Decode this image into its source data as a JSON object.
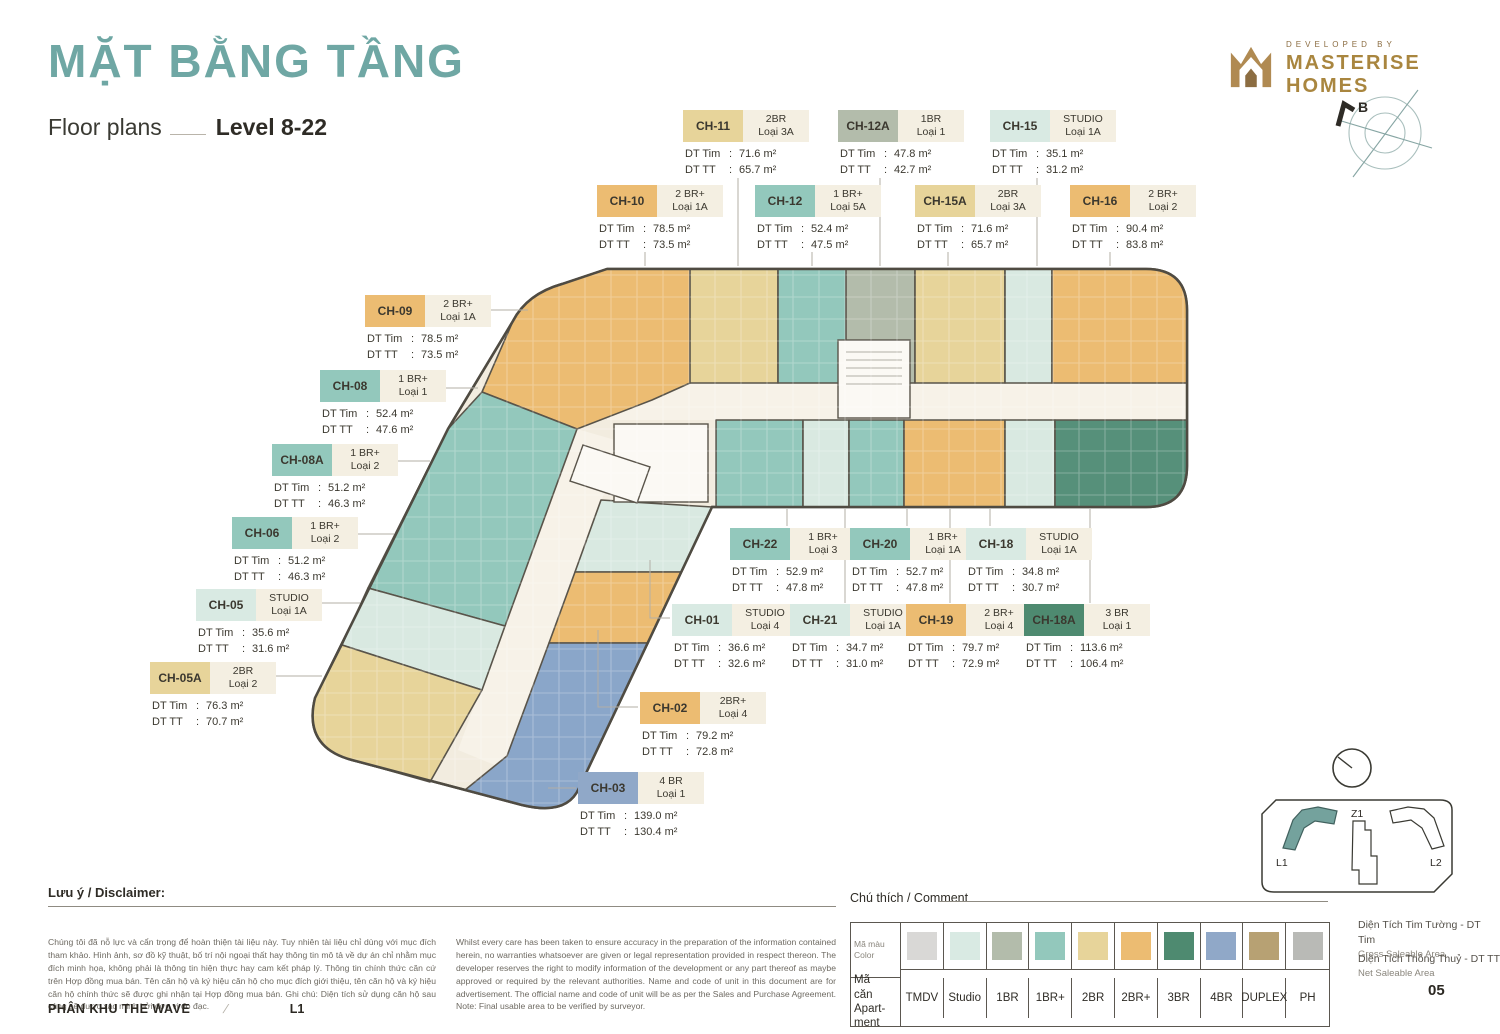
{
  "header": {
    "title": "MẶT BẰNG TẦNG",
    "subtitle_left": "Floor plans",
    "subtitle_right": "Level 8-22",
    "developer_label": "DEVELOPED BY",
    "developer_name": "MASTERISE HOMES",
    "compass_label": "B"
  },
  "colors": {
    "tmdv": "#d9d8d6",
    "studio": "#d9eae3",
    "br1": "#b3bcab",
    "br1p": "#93c8bc",
    "br2": "#e7d49a",
    "br2p": "#ecbc72",
    "br3": "#4e8a70",
    "br4": "#90a8c8",
    "duplex": "#b7a173",
    "ph": "#b9bab6"
  },
  "callout_labels": {
    "dt_tim": "DT Tim",
    "dt_tt": "DT TT"
  },
  "callouts": [
    {
      "code": "CH-11",
      "type": "2BR",
      "loai": "Loại 3A",
      "dt_tim": "71.6 m²",
      "dt_tt": "65.7 m²",
      "key": "br2",
      "x": 683,
      "y": 110
    },
    {
      "code": "CH-12A",
      "type": "1BR",
      "loai": "Loại 1",
      "dt_tim": "47.8 m²",
      "dt_tt": "42.7 m²",
      "key": "br1",
      "x": 838,
      "y": 110
    },
    {
      "code": "CH-15",
      "type": "STUDIO",
      "loai": "Loại 1A",
      "dt_tim": "35.1 m²",
      "dt_tt": "31.2 m²",
      "key": "studio",
      "x": 990,
      "y": 110
    },
    {
      "code": "CH-10",
      "type": "2 BR+",
      "loai": "Loại 1A",
      "dt_tim": "78.5 m²",
      "dt_tt": "73.5 m²",
      "key": "br2p",
      "x": 597,
      "y": 185
    },
    {
      "code": "CH-12",
      "type": "1 BR+",
      "loai": "Loại 5A",
      "dt_tim": "52.4 m²",
      "dt_tt": "47.5 m²",
      "key": "br1p",
      "x": 755,
      "y": 185
    },
    {
      "code": "CH-15A",
      "type": "2BR",
      "loai": "Loại 3A",
      "dt_tim": "71.6 m²",
      "dt_tt": "65.7 m²",
      "key": "br2",
      "x": 915,
      "y": 185
    },
    {
      "code": "CH-16",
      "type": "2 BR+",
      "loai": "Loại 2",
      "dt_tim": "90.4 m²",
      "dt_tt": "83.8 m²",
      "key": "br2p",
      "x": 1070,
      "y": 185
    },
    {
      "code": "CH-09",
      "type": "2 BR+",
      "loai": "Loại 1A",
      "dt_tim": "78.5 m²",
      "dt_tt": "73.5 m²",
      "key": "br2p",
      "x": 365,
      "y": 295
    },
    {
      "code": "CH-08",
      "type": "1 BR+",
      "loai": "Loại 1",
      "dt_tim": "52.4 m²",
      "dt_tt": "47.6 m²",
      "key": "br1p",
      "x": 320,
      "y": 370
    },
    {
      "code": "CH-08A",
      "type": "1 BR+",
      "loai": "Loại 2",
      "dt_tim": "51.2 m²",
      "dt_tt": "46.3 m²",
      "key": "br1p",
      "x": 272,
      "y": 444
    },
    {
      "code": "CH-06",
      "type": "1 BR+",
      "loai": "Loại 2",
      "dt_tim": "51.2 m²",
      "dt_tt": "46.3 m²",
      "key": "br1p",
      "x": 232,
      "y": 517
    },
    {
      "code": "CH-05",
      "type": "STUDIO",
      "loai": "Loại 1A",
      "dt_tim": "35.6 m²",
      "dt_tt": "31.6 m²",
      "key": "studio",
      "x": 196,
      "y": 589
    },
    {
      "code": "CH-05A",
      "type": "2BR",
      "loai": "Loại 2",
      "dt_tim": "76.3 m²",
      "dt_tt": "70.7 m²",
      "key": "br2",
      "x": 150,
      "y": 662
    },
    {
      "code": "CH-22",
      "type": "1 BR+",
      "loai": "Loại 3",
      "dt_tim": "52.9 m²",
      "dt_tt": "47.8 m²",
      "key": "br1p",
      "x": 730,
      "y": 528
    },
    {
      "code": "CH-20",
      "type": "1 BR+",
      "loai": "Loại 1A",
      "dt_tim": "52.7 m²",
      "dt_tt": "47.8 m²",
      "key": "br1p",
      "x": 850,
      "y": 528
    },
    {
      "code": "CH-18",
      "type": "STUDIO",
      "loai": "Loại 1A",
      "dt_tim": "34.8 m²",
      "dt_tt": "30.7 m²",
      "key": "studio",
      "x": 966,
      "y": 528
    },
    {
      "code": "CH-01",
      "type": "STUDIO",
      "loai": "Loại 4",
      "dt_tim": "36.6 m²",
      "dt_tt": "32.6 m²",
      "key": "studio",
      "x": 672,
      "y": 604
    },
    {
      "code": "CH-21",
      "type": "STUDIO",
      "loai": "Loại 1A",
      "dt_tim": "34.7 m²",
      "dt_tt": "31.0 m²",
      "key": "studio",
      "x": 790,
      "y": 604
    },
    {
      "code": "CH-19",
      "type": "2 BR+",
      "loai": "Loại 4",
      "dt_tim": "79.7 m²",
      "dt_tt": "72.9 m²",
      "key": "br2p",
      "x": 906,
      "y": 604
    },
    {
      "code": "CH-18A",
      "type": "3 BR",
      "loai": "Loại 1",
      "dt_tim": "113.6 m²",
      "dt_tt": "106.4 m²",
      "key": "br3",
      "x": 1024,
      "y": 604
    },
    {
      "code": "CH-02",
      "type": "2BR+",
      "loai": "Loại 4",
      "dt_tim": "79.2 m²",
      "dt_tt": "72.8 m²",
      "key": "br2p",
      "x": 640,
      "y": 692
    },
    {
      "code": "CH-03",
      "type": "4 BR",
      "loai": "Loại 1",
      "dt_tim": "139.0 m²",
      "dt_tt": "130.4 m²",
      "key": "br4",
      "x": 578,
      "y": 772
    }
  ],
  "legend": {
    "title": "Chú thích / Comment",
    "row1": {
      "vi": "Mã màu",
      "en": "Color"
    },
    "row2": {
      "vi": "Mã căn",
      "en": "Apart- ment"
    },
    "items": [
      {
        "label": "TMDV",
        "key": "tmdv"
      },
      {
        "label": "Studio",
        "key": "studio"
      },
      {
        "label": "1BR",
        "key": "br1"
      },
      {
        "label": "1BR+",
        "key": "br1p"
      },
      {
        "label": "2BR",
        "key": "br2"
      },
      {
        "label": "2BR+",
        "key": "br2p"
      },
      {
        "label": "3BR",
        "key": "br3"
      },
      {
        "label": "4BR",
        "key": "br4"
      },
      {
        "label": "DUPLEX",
        "key": "duplex"
      },
      {
        "label": "PH",
        "key": "ph"
      }
    ]
  },
  "disclaimer": {
    "title": "Lưu ý / Disclaimer:",
    "vi": "Chúng tôi đã nỗ lực và cẩn trọng để hoàn thiện tài liệu này. Tuy nhiên tài liệu chỉ dùng với mục đích tham khảo. Hình ảnh, sơ đồ kỹ thuật, bố trí nội ngoại thất hay thông tin mô tả về dự án chỉ nhằm mục đích minh họa, không phải là thông tin hiện thực hay cam kết pháp lý. Thông tin chính thức căn cứ trên Hợp đồng mua bán. Tên căn hộ và ký hiệu căn hộ cho mục đích giới thiệu, tên căn hộ và ký hiệu căn hộ chính thức sẽ được ghi nhận tại Hợp đồng mua bán. Ghi chú: Diện tích sử dụng căn hộ sau cùng sẽ được xác minh bởi đơn vị đo đạc.",
    "en": "Whilst every care has been taken to ensure accuracy in the preparation of the information contained herein, no warranties whatsoever are given or legal representation provided in respect thereon. The developer reserves the right to modify information of the development or any part thereof as maybe approved or required by the relevant authorities. Name and code of unit in this document are for advertisement. The official name and code of unit will be as per the Sales and Purchase Agreement. Note: Final usable area to be verified by surveyor."
  },
  "area_notes": [
    {
      "vi": "Diện Tích Tim Tường - DT Tim",
      "en": "Gross Saleable Area"
    },
    {
      "vi": "Diện Tích Thông Thuỷ - DT TT",
      "en": "Net Saleable Area"
    }
  ],
  "minimap": {
    "l1": "L1",
    "z1": "Z1",
    "l2": "L2"
  },
  "footer": {
    "zone": "PHÂN KHU THE WAVE",
    "level": "L1",
    "page": "05"
  }
}
